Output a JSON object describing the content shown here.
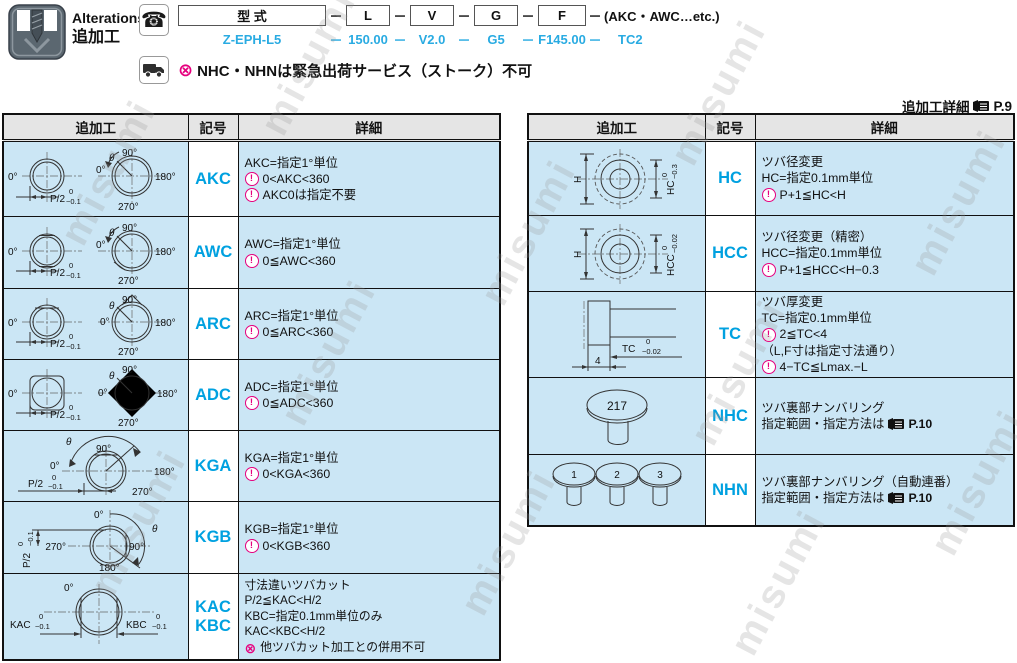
{
  "watermark": "misumi",
  "colors": {
    "accent_cyan": "#00A1E0",
    "example_cyan": "#29ABE2",
    "magenta": "#E6007E",
    "row_blue": "#CBE6F5",
    "header_gray": "#E5E5E5"
  },
  "icon_glyphs": {
    "caution": "!",
    "prohibited": "⊗",
    "phone": "☎"
  },
  "header": {
    "title_en": "Alterations",
    "title_jp": "追加工",
    "formula": {
      "model_box": "型 式",
      "dash": "－",
      "boxes": [
        "L",
        "V",
        "G",
        "F"
      ],
      "suffix": "(AKC・AWC…etc.)"
    },
    "example": {
      "dash": "－",
      "model": "Z-EPH-L5",
      "l": "150.00",
      "v": "V2.0",
      "g": "G5",
      "f": "F145.00",
      "alt": "TC2"
    },
    "shipping_note": "NHC・NHNは緊急出荷サービス（ストーク）不可",
    "detail_ref": {
      "label": "追加工詳細",
      "page": "P.9"
    }
  },
  "table_columns": {
    "process": "追加工",
    "symbol": "記号",
    "detail": "詳細"
  },
  "diagrams": {
    "angle": {
      "deg0": "0°",
      "deg90": "90°",
      "deg180": "180°",
      "deg270": "270°",
      "theta": "θ",
      "p_half": "P/2",
      "tol0": "0",
      "tol01": "−0.1"
    },
    "kac": {
      "kac": "KAC",
      "kbc": "KBC"
    },
    "hc": {
      "h": "H",
      "label": "HC",
      "tol0": "0",
      "tol": "−0.3"
    },
    "hcc": {
      "h": "H",
      "label": "HCC",
      "tol0": "0",
      "tol": "−0.02"
    },
    "tc": {
      "label": "TC",
      "tol0": "0",
      "tol": "−0.02",
      "four": "4"
    },
    "nhc": {
      "num": "217"
    },
    "nhn": {
      "n1": "1",
      "n2": "2",
      "n3": "3"
    }
  },
  "left_table": {
    "rows": [
      {
        "symbol": "AKC",
        "lines": [
          "AKC=指定1°単位",
          "0<AKC<360",
          "AKC0は指定不要"
        ]
      },
      {
        "symbol": "AWC",
        "lines": [
          "AWC=指定1°単位",
          "0≦AWC<360"
        ]
      },
      {
        "symbol": "ARC",
        "lines": [
          "ARC=指定1°単位",
          "0≦ARC<360"
        ]
      },
      {
        "symbol": "ADC",
        "lines": [
          "ADC=指定1°単位",
          "0≦ADC<360"
        ]
      },
      {
        "symbol": "KGA",
        "lines": [
          "KGA=指定1°単位",
          "0<KGA<360"
        ]
      },
      {
        "symbol": "KGB",
        "lines": [
          "KGB=指定1°単位",
          "0<KGB<360"
        ]
      },
      {
        "symbol": "KAC",
        "symbol2": "KBC",
        "lines": [
          "寸法違いツバカット",
          "P/2≦KAC<H/2",
          "KBC=指定0.1mm単位のみ",
          "KAC<KBC<H/2",
          "他ツバカット加工との併用不可"
        ]
      }
    ]
  },
  "right_table": {
    "rows": [
      {
        "symbol": "HC",
        "lines": [
          "ツバ径変更",
          "HC=指定0.1mm単位",
          "P+1≦HC<H"
        ]
      },
      {
        "symbol": "HCC",
        "lines": [
          "ツバ径変更（精密）",
          "HCC=指定0.1mm単位",
          "P+1≦HCC<H−0.3"
        ]
      },
      {
        "symbol": "TC",
        "lines": [
          "ツバ厚変更",
          "TC=指定0.1mm単位",
          "2≦TC<4",
          "（L,F寸は指定寸法通り）",
          "4−TC≦Lmax.−L"
        ]
      },
      {
        "symbol": "NHC",
        "lines": [
          "ツバ裏部ナンバリング",
          "指定範囲・指定方法は"
        ],
        "page": "P.10"
      },
      {
        "symbol": "NHN",
        "lines": [
          "ツバ裏部ナンバリング（自動連番）",
          "指定範囲・指定方法は"
        ],
        "page": "P.10"
      }
    ]
  }
}
